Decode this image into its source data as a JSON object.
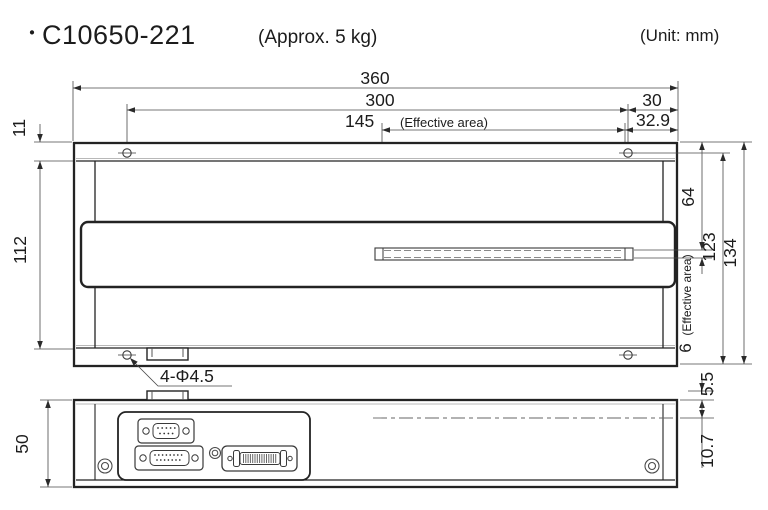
{
  "title": {
    "bullet": "・",
    "model": "C10650-221",
    "weight_note": "(Approx. 5 kg)"
  },
  "unit_note": "(Unit: mm)",
  "front_view": {
    "dims": {
      "overall_width": "360",
      "mount_hole_span": "300",
      "hole_to_edge": "30",
      "effective_area_width": "145",
      "effective_area_width_note": "(Effective area)",
      "effective_to_edge": "32.9",
      "top_flange_height": "11",
      "body_height": "112",
      "top_to_effective": "64",
      "flange_to_bottom": "123",
      "overall_height": "134",
      "effective_area_height": "6",
      "effective_area_height_note": "(Effective area)",
      "mount_holes_label": "4-Φ4.5"
    }
  },
  "side_view": {
    "dims": {
      "height": "50",
      "tab_protrusion": "5.5",
      "axis_offset": "10.7"
    }
  }
}
